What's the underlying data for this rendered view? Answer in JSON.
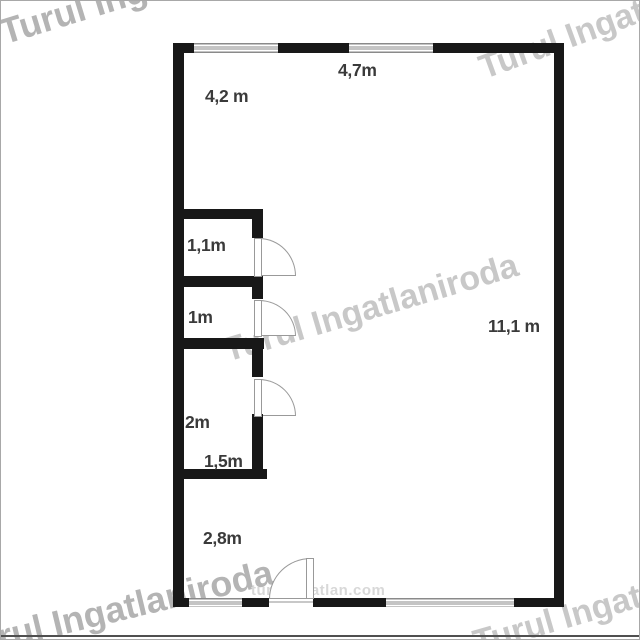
{
  "floorplan": {
    "dimension_labels": {
      "top_window": "4,7m",
      "upper_room_width": "4,2 m",
      "storage_top": "1,1m",
      "storage_middle": "1m",
      "storage_bottom": "2m",
      "storage_bottom_width": "1,5m",
      "lower_hall_width": "2,8m",
      "main_room_length": "11,1 m"
    }
  },
  "watermarks": {
    "brand": "Turul Ingatlaniroda",
    "website": "turulingatlan.com"
  },
  "colors": {
    "wall": "#181818",
    "label-text": "#3a3a3a",
    "door-stroke": "#999999",
    "window-line": "#8a8a8a",
    "watermark-dark": "#b4b4b4",
    "watermark-light": "#c8c8c8",
    "watermark-url": "#d8d8d8",
    "plan-bg": "#ffffff",
    "frame-border": "#a8a8a8",
    "frame-bottom": "#4f4f4f"
  }
}
